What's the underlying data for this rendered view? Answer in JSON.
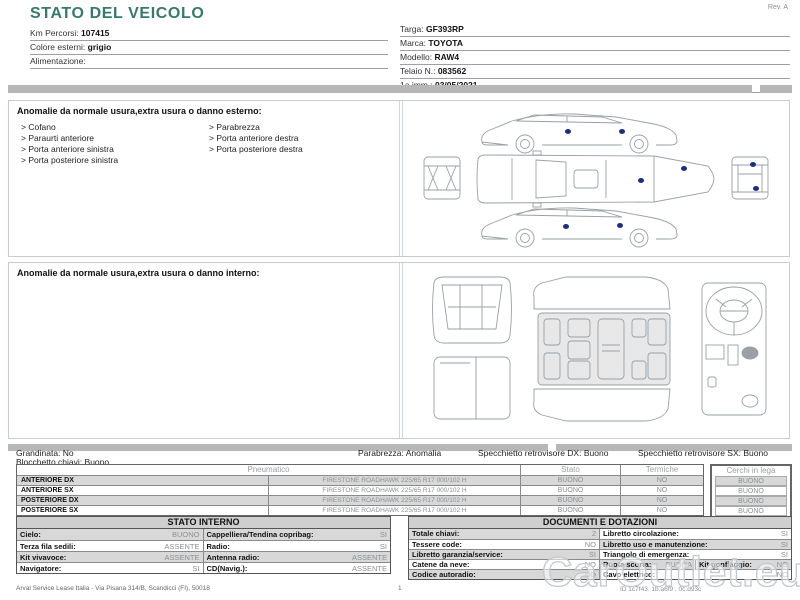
{
  "meta": {
    "rev": "Rev. A"
  },
  "title": "STATO DEL VEICOLO",
  "header": {
    "left": [
      {
        "label": "Km Percorsi:",
        "value": "107415"
      },
      {
        "label": "Colore esterni:",
        "value": "grigio"
      },
      {
        "label": "Alimentazione:",
        "value": ""
      }
    ],
    "right": [
      {
        "label": "Targa:",
        "value": "GF393RP"
      },
      {
        "label": "Marca:",
        "value": "TOYOTA"
      },
      {
        "label": "Modello:",
        "value": "RAW4"
      },
      {
        "label": "Telaio N.:",
        "value": "083562"
      },
      {
        "label": "1a imm.:",
        "value": "03/05/2021"
      }
    ]
  },
  "exterior_section": {
    "title": "Anomalie da normale usura,extra usura o danno esterno:",
    "items_left": [
      "Cofano",
      "Paraurti anteriore",
      "Porta anteriore sinistra",
      "Porta posteriore sinistra"
    ],
    "items_right": [
      "Parabrezza",
      "Porta anteriore destra",
      "Porta posteriore destra"
    ]
  },
  "interior_section": {
    "title": "Anomalie da normale usura,extra usura o danno interno:"
  },
  "exterior_diagram": {
    "damage_dots": [
      {
        "x": 152,
        "y": 27
      },
      {
        "x": 206,
        "y": 27
      },
      {
        "x": 225,
        "y": 76
      },
      {
        "x": 268,
        "y": 64
      },
      {
        "x": 337,
        "y": 60
      },
      {
        "x": 340,
        "y": 84
      },
      {
        "x": 150,
        "y": 122
      },
      {
        "x": 204,
        "y": 121
      }
    ]
  },
  "condition_summary": [
    {
      "label": "Grandinata:",
      "value": "No"
    },
    {
      "label": "Parabrezza:",
      "value": "Anomalia"
    },
    {
      "label": "Specchietto retrovisore DX:",
      "value": "Buono"
    },
    {
      "label": "Specchietto retrovisore SX:",
      "value": "Buono"
    },
    {
      "label": "Blocchetto chiavi:",
      "value": "Buono"
    }
  ],
  "tyres_table": {
    "headers": [
      "Pneumatico",
      "Stato",
      "Termiche",
      "Cerchi in lega"
    ],
    "rows": [
      {
        "position": "ANTERIORE DX",
        "tyre": "FIRESTONE ROADHAWK 225/65 R17 000/102 H",
        "stato": "BUONO",
        "termiche": "NO",
        "cerchi": "BUONO"
      },
      {
        "position": "ANTERIORE SX",
        "tyre": "FIRESTONE ROADHAWK 225/65 R17 000/102 H",
        "stato": "BUONO",
        "termiche": "NO",
        "cerchi": "BUONO"
      },
      {
        "position": "POSTERIORE DX",
        "tyre": "FIRESTONE ROADHAWK 225/65 R17 000/102 H",
        "stato": "BUONO",
        "termiche": "NO",
        "cerchi": "BUONO"
      },
      {
        "position": "POSTERIORE SX",
        "tyre": "FIRESTONE ROADHAWK 225/65 R17 000/102 H",
        "stato": "BUONO",
        "termiche": "NO",
        "cerchi": "BUONO"
      }
    ]
  },
  "stato_interno": {
    "title": "STATO INTERNO",
    "rows": [
      {
        "l1": "Cielo:",
        "v1": "BUONO",
        "l2": "Cappelliera/Tendina copribag:",
        "v2": "SI"
      },
      {
        "l1": "Terza fila sedili:",
        "v1": "ASSENTE",
        "l2": "Radio:",
        "v2": "SI"
      },
      {
        "l1": "Kit vivavoce:",
        "v1": "ASSENTE",
        "l2": "Antenna radio:",
        "v2": "ASSENTE"
      },
      {
        "l1": "Navigatore:",
        "v1": "SI",
        "l2": "CD(Navig.):",
        "v2": "ASSENTE"
      }
    ]
  },
  "documenti": {
    "title": "DOCUMENTI E DOTAZIONI",
    "rows": [
      {
        "l1": "Totale chiavi:",
        "v1": "2",
        "l2": "Libretto circolazione:",
        "v2": "SI"
      },
      {
        "l1": "Tessere code:",
        "v1": "NO",
        "l2": "Libretto uso e manutenzione:",
        "v2": "SI"
      },
      {
        "l1": "Libretto garanzia/service:",
        "v1": "SI",
        "l2": "Triangolo di emergenza:",
        "v2": "SI"
      },
      {
        "l1": "Catene da neve:",
        "v1": "NO",
        "l2": "Ruota scorta:",
        "v2": "BUONA",
        "l3": "Kit gonfiaggio:",
        "v3": "NO"
      },
      {
        "l1": "Codice autoradio:",
        "v1": "NO",
        "l2": "Cavo elettrico:",
        "v2": "NO"
      }
    ]
  },
  "footer": {
    "company": "Arval Service Lease Italia - Via Pisana 314/B, Scandicci (FI), 50018",
    "page": "1",
    "doc_id": "ID 1c7f43. 1b.a6f9 , 0c.d93c",
    "watermark": "CarOutlet.eu"
  },
  "colors": {
    "accent_teal": "#367a6b",
    "bar_gray": "#b7b7b7",
    "row_gray": "#d8d8d8",
    "muted_text": "#8b9094",
    "damage_dot": "#1c2e83"
  }
}
